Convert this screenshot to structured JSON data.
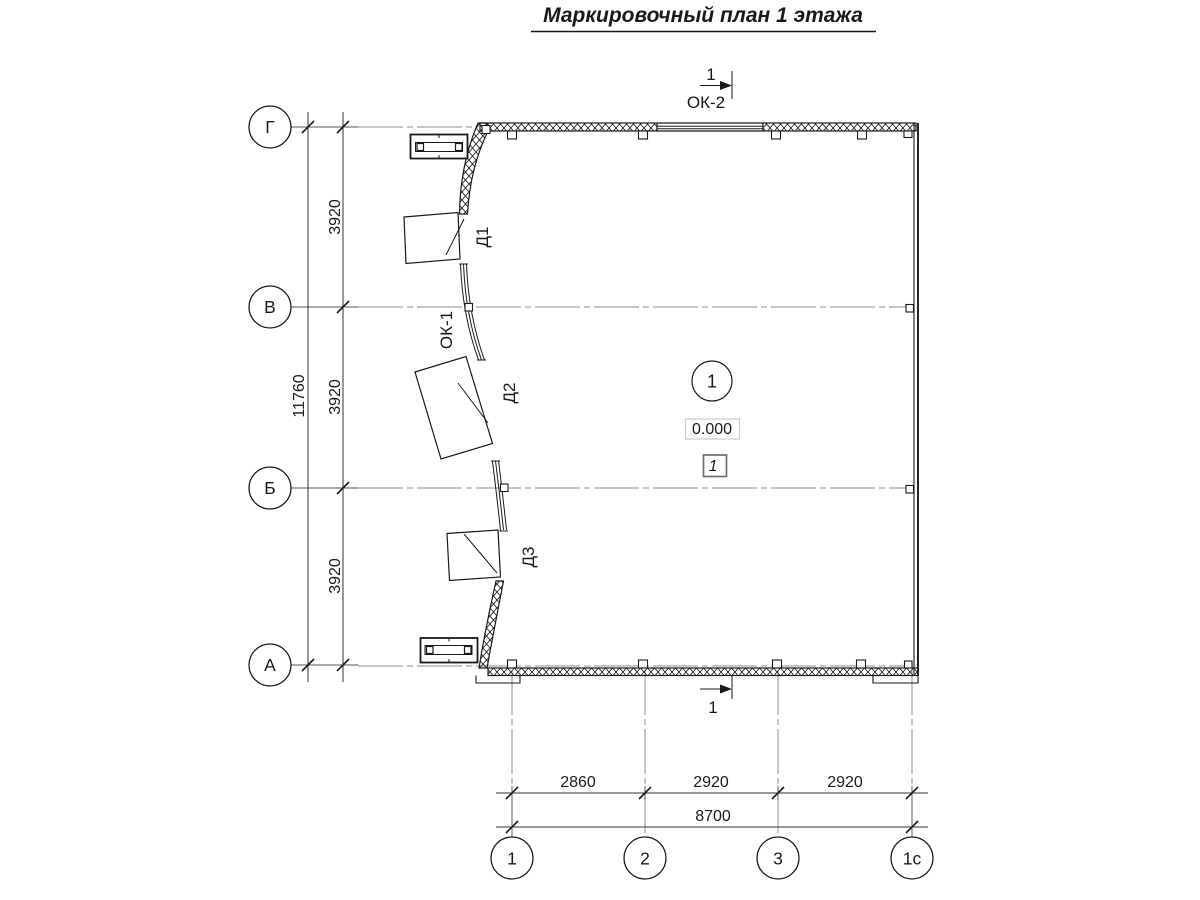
{
  "title": "Маркировочный план 1 этажа",
  "axes": {
    "left": [
      {
        "label": "Г"
      },
      {
        "label": "В"
      },
      {
        "label": "Б"
      },
      {
        "label": "А"
      }
    ],
    "bottom": [
      {
        "label": "1"
      },
      {
        "label": "2"
      },
      {
        "label": "3"
      },
      {
        "label": "1с"
      }
    ]
  },
  "dimensions": {
    "left": {
      "seg1": "3920",
      "seg2": "3920",
      "seg3": "3920",
      "total": "11760"
    },
    "bottom": {
      "seg1": "2860",
      "seg2": "2920",
      "seg3": "2920",
      "total": "8700"
    }
  },
  "doors": {
    "d1": "Д1",
    "d2": "Д2",
    "d3": "Д3"
  },
  "windows": {
    "ok1": "ОК-1",
    "ok2": "ОК-2"
  },
  "section_marks": {
    "top": "1",
    "bottom": "1"
  },
  "room": {
    "number": "1",
    "elevation": "0.000",
    "tag": "1"
  },
  "colors": {
    "ink": "#1a1a1a",
    "axis_line": "#8f8f8f",
    "elevation_border": "#cccccc",
    "tag_border": "#6e6e6e"
  }
}
